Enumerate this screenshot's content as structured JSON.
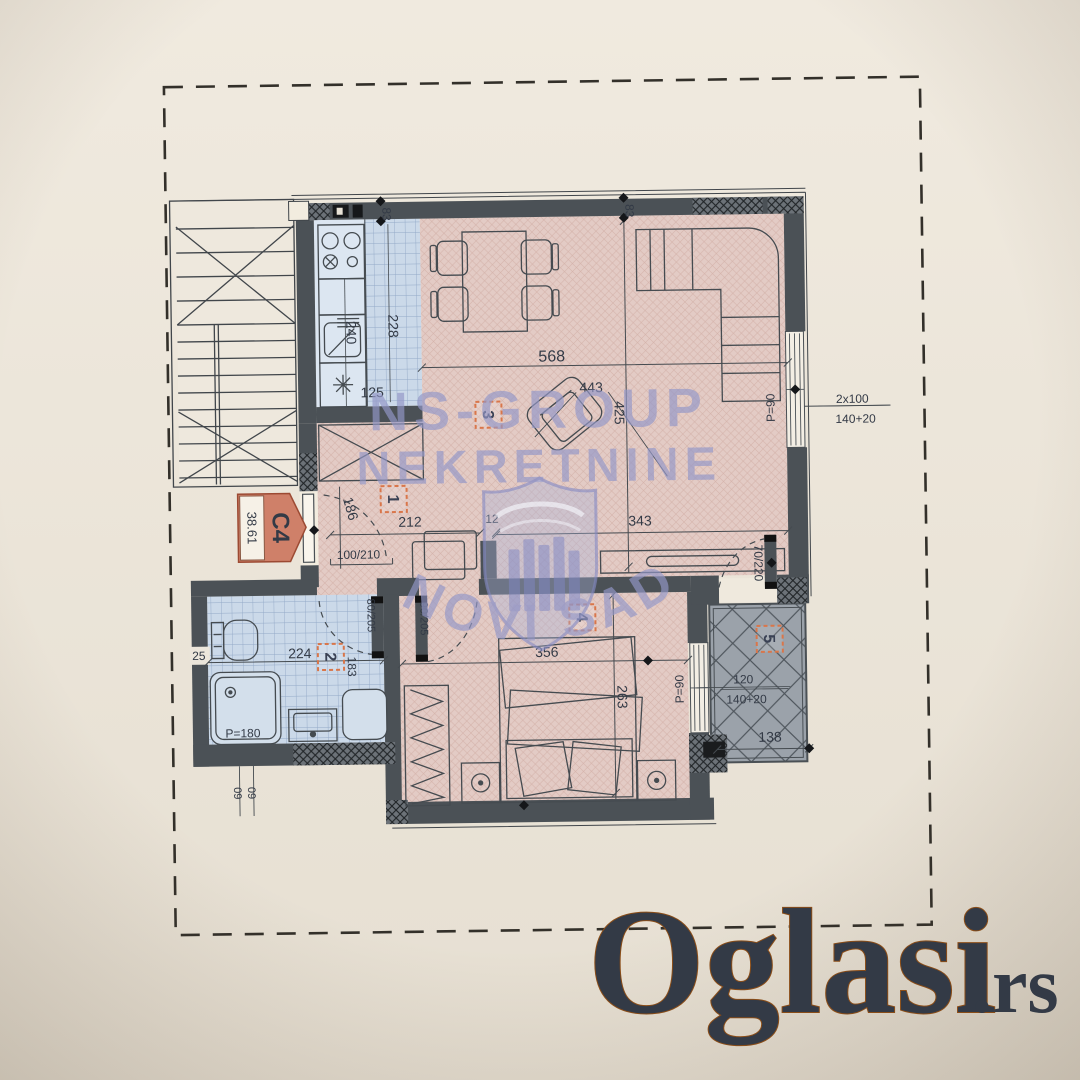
{
  "badge": {
    "code": "C4",
    "area": "38.61"
  },
  "watermark": {
    "line1": "NS-GROUP",
    "line2": "NEKRETNINE",
    "arc": "NOVI SAD"
  },
  "logo": {
    "brand": "Oglasi",
    "tld": ".rs"
  },
  "rooms": {
    "hall": {
      "number": "1",
      "width": "212",
      "entry_depth": "186",
      "entry_door": "100/210",
      "wall_thickness": "12"
    },
    "bathroom": {
      "number": "2",
      "width": "224",
      "depth": "183",
      "door": "80/205",
      "shower": "P=180",
      "wall": "25",
      "shaft_a": "60",
      "shaft_b": "60"
    },
    "living": {
      "number": "3",
      "width": "568",
      "diagonal": "443",
      "depth": "425",
      "clear_width": "343",
      "wall_seg_left": "83",
      "wall_seg_right": "83",
      "balcony_door": "70/220"
    },
    "kitchen": {
      "counter": "240",
      "floor": "228",
      "width": "125"
    },
    "bedroom": {
      "number": "4",
      "width": "356",
      "depth": "263",
      "door": "90/205",
      "window_parapet": "P=90"
    },
    "terrace": {
      "number": "5",
      "width": "138",
      "window_width": "120",
      "window_height": "140+20"
    }
  },
  "windows": {
    "living": {
      "size": "2x100",
      "height": "140+20",
      "parapet": "P=90"
    }
  },
  "colors": {
    "paper": "#ece6db",
    "wall": "#4b5156",
    "floor_pink": "#e3cbc5",
    "tile_blue": "#cbd9e9",
    "terrace_gray": "#9ba2aa",
    "badge_salmon": "#cf8069",
    "badge_text": "#7c2115",
    "room_box_orange": "#d9764a",
    "watermark_blue": "#9497c8",
    "logo_orange": "#ef8f2e",
    "logo_tld_gray": "#8e8d8b"
  }
}
